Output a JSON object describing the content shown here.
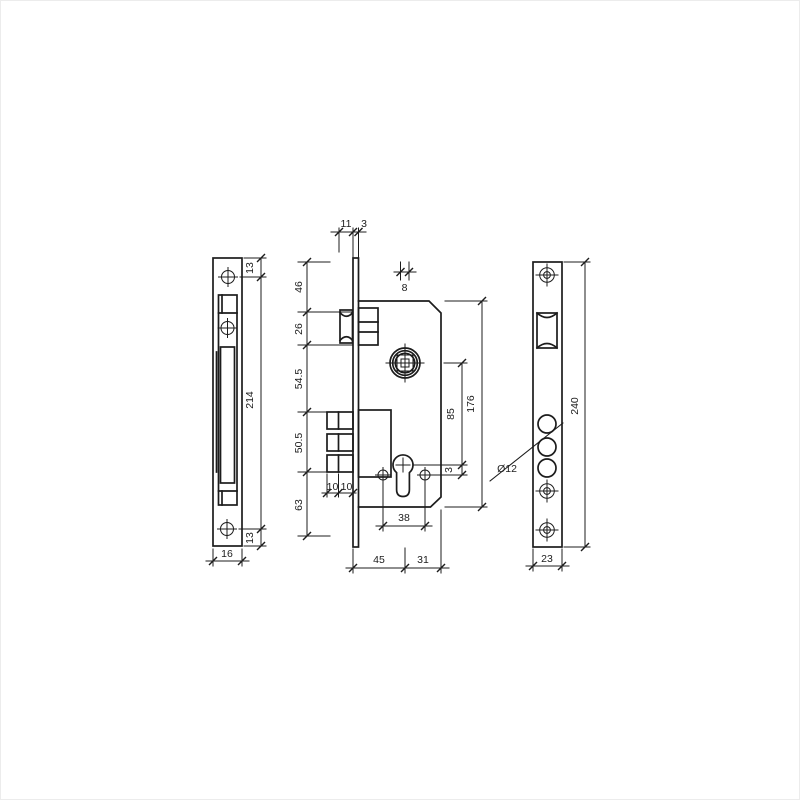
{
  "colors": {
    "line": "#1c1c1c",
    "background": "#ffffff"
  },
  "views": {
    "strike_plate": {
      "label": "strike-plate-side-view",
      "dims": {
        "top_screw_offset": "13",
        "length": "214",
        "bottom_screw_offset": "13",
        "width": "16"
      }
    },
    "lock_body": {
      "label": "lock-body-side-view",
      "dims": {
        "latch_projection": "11",
        "faceplate_thickness": "3",
        "spindle_width": "8",
        "seg_top": "46",
        "seg_latch": "26",
        "seg_mid": "54.5",
        "seg_bolt": "50.5",
        "seg_bottom": "63",
        "bolt_step_left": "10",
        "bolt_step_right": "10",
        "center_distance": "85",
        "cylinder_screw_offset": "3",
        "case_height": "176",
        "screw_spacing": "38",
        "backset": "45",
        "case_depth": "31"
      }
    },
    "faceplate": {
      "label": "faceplate-front-view",
      "dims": {
        "hole_diameter": "Ø12",
        "length": "240",
        "width": "23"
      }
    }
  }
}
